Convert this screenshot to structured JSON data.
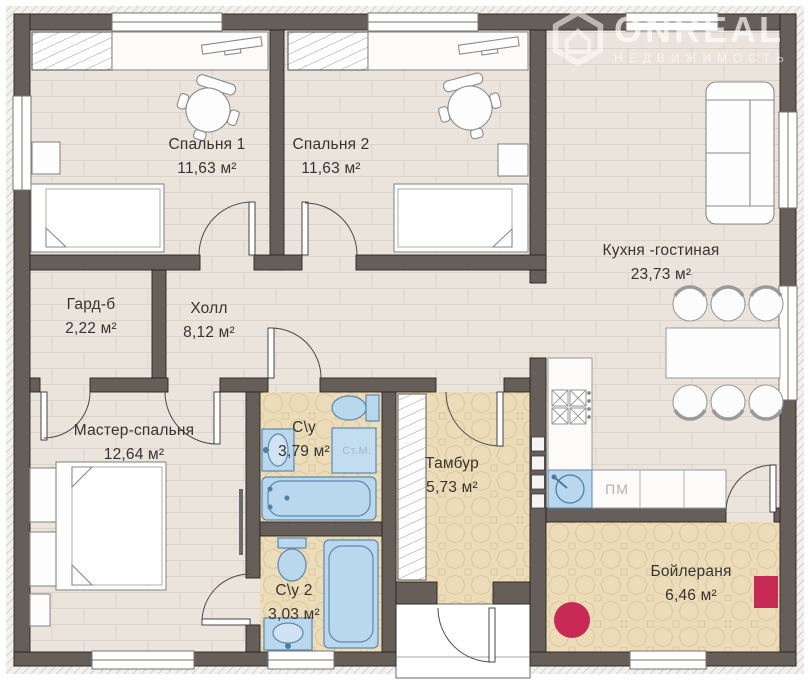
{
  "watermark": {
    "brand": "ONREAL",
    "tagline": "НЕДВИЖИМОСТЬ"
  },
  "floor_plan": {
    "rooms": [
      {
        "id": "bedroom-1",
        "name": "Спальня 1",
        "area": "11,63 м²"
      },
      {
        "id": "bedroom-2",
        "name": "Спальня 2",
        "area": "11,63 м²"
      },
      {
        "id": "kitchen-living",
        "name": "Кухня -гостиная",
        "area": "23,73 м²"
      },
      {
        "id": "wardrobe",
        "name": "Гард-б",
        "area": "2,22 м²"
      },
      {
        "id": "hall",
        "name": "Холл",
        "area": "8,12 м²"
      },
      {
        "id": "master-bedroom",
        "name": "Мастер-спальня",
        "area": "12,64 м²"
      },
      {
        "id": "bathroom-1",
        "name": "С\\у",
        "area": "3,79 м²"
      },
      {
        "id": "vestibule",
        "name": "Тамбур",
        "area": "5,73 м²"
      },
      {
        "id": "bathroom-2",
        "name": "С\\у 2",
        "area": "3,03 м²"
      },
      {
        "id": "boiler-room",
        "name": "Бойлераня",
        "area": "6,46 м²"
      }
    ],
    "appliance_labels": {
      "washing_machine": "Ст.М.",
      "dishwasher": "ПМ"
    },
    "colors": {
      "wall": "#665f59",
      "plank_floor": "#ebe4dc",
      "tile_floor": "#ecdcba",
      "fixture_fill": "#b9d8ee",
      "fixture_stroke": "#5d88ac",
      "boiler_accent": "#c92a55"
    }
  }
}
